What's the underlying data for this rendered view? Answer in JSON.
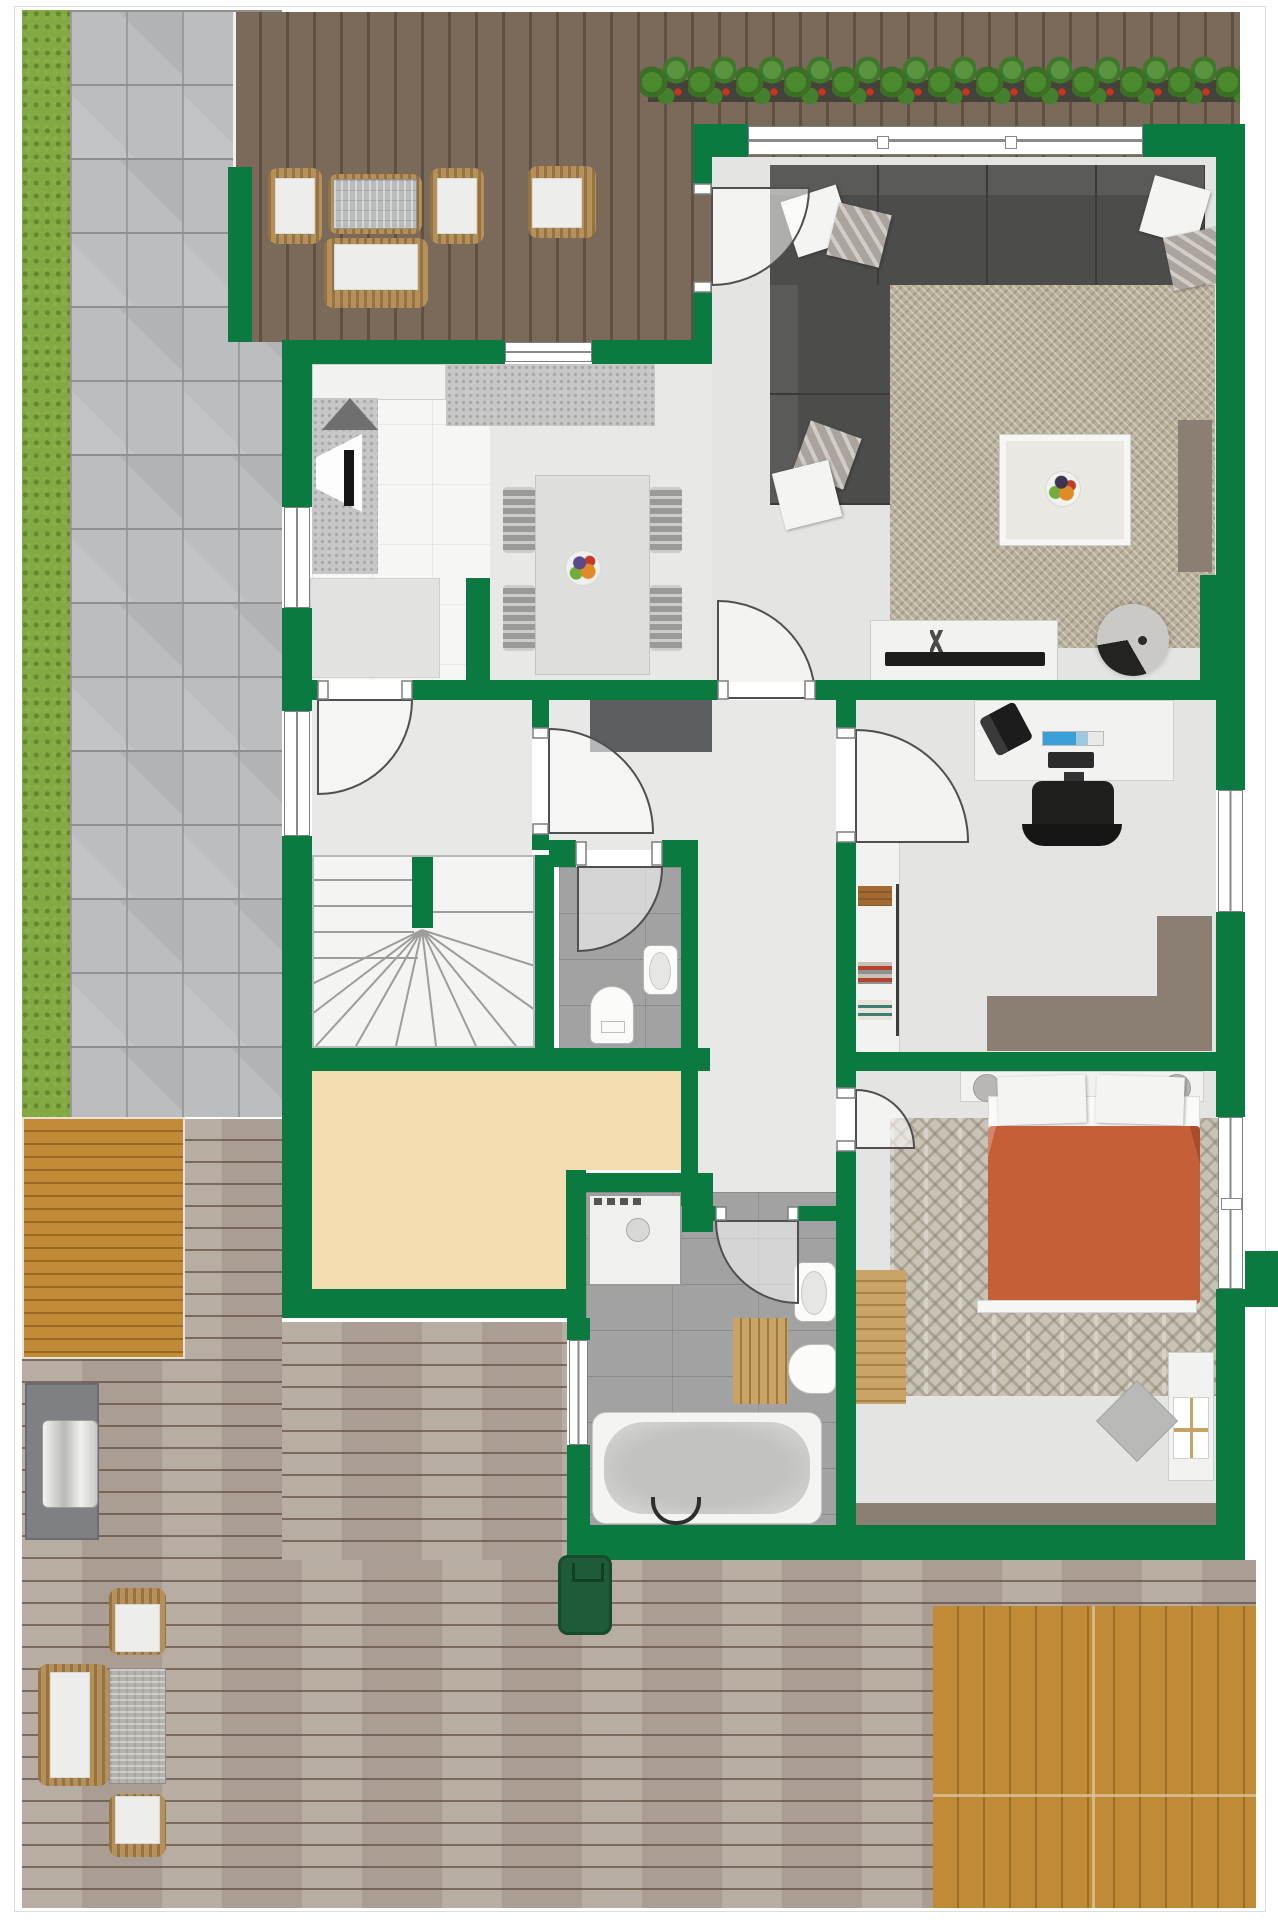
{
  "document": {
    "type": "architectural floor plan, top-down 3D render",
    "visible_text": [],
    "notes": "Ground floor plan with green walls, surrounded by lawn strip, paved path, two wooden terraces and a flower border. No text labels are rendered in the image."
  },
  "palette": {
    "wall": "#0a7a40",
    "grass": "#83a943",
    "paver": "#bcbdbf",
    "deck_top": "#7b6a59",
    "deck_bottom": "#b3a79c",
    "deck_gold": "#c08a37",
    "floor": "#e4e4e3",
    "kitchen_floor": "#f6f6f5",
    "tile_gray": "#a2a2a2",
    "beige": "#f5ddb2",
    "rug_living": "#b9b09c",
    "rug_bedroom": "#c9c3b5",
    "sofa": "#4c4c4a",
    "taupe": "#8b7e72",
    "duvet": "#c45f38",
    "wood_tan": "#c9a368",
    "wicker": "#b6905a",
    "bin_green": "#1e5b38",
    "soil": "#45423a",
    "leaf": "#4c8a2e",
    "bloom": "#d0331c",
    "door_line": "#4f4f4f"
  },
  "outdoor": {
    "areas": [
      "lawn-strip-west",
      "paved-path",
      "upper-terrace-dark-wood",
      "flower-border",
      "lower-terrace-grey-wood",
      "golden-deck-panel-west",
      "golden-deck-panel-southeast"
    ],
    "items": [
      "terrace-armchair",
      "terrace-armchair",
      "terrace-glass-table",
      "terrace-sofa",
      "terrace-side-chair",
      "garden-lounge-chair",
      "garden-lounge-chair",
      "garden-sofa",
      "garden-wicker-table",
      "outdoor-grill-station",
      "green-wheelie-bin"
    ]
  },
  "rooms": [
    {
      "name": "living-room",
      "furniture": [
        "corner-sofa",
        "throw-pillows",
        "area-rug",
        "coffee-table-tray",
        "fruit-bowl",
        "tv-sideboard",
        "television",
        "round-fan",
        "side-bench"
      ]
    },
    {
      "name": "kitchen",
      "furniture": [
        "upper-counter",
        "worktop",
        "extractor-hood",
        "corner-sink",
        "kitchen-island"
      ]
    },
    {
      "name": "dining-area",
      "furniture": [
        "dining-table",
        "dining-chairs-x4",
        "fruit-bowl",
        "dark-sideboard"
      ]
    },
    {
      "name": "entrance-vestibule",
      "furniture": []
    },
    {
      "name": "staircase",
      "furniture": [
        "winder-stairs"
      ]
    },
    {
      "name": "guest-wc",
      "furniture": [
        "wall-sink",
        "toilet"
      ]
    },
    {
      "name": "office",
      "furniture": [
        "desk",
        "desk-phone",
        "monitor",
        "keyboard",
        "office-chair",
        "bookshelf",
        "l-shaped-side-desk"
      ]
    },
    {
      "name": "storage-room-beige",
      "furniture": []
    },
    {
      "name": "corridor",
      "furniture": []
    },
    {
      "name": "bathroom",
      "furniture": [
        "shower",
        "bathtub",
        "wall-sink",
        "second-basin",
        "wooden-bath-mat"
      ]
    },
    {
      "name": "bedroom",
      "furniture": [
        "double-bed-orange-duvet",
        "headboard-nightstands",
        "bedside-lamps",
        "bedroom-rug",
        "wood-bench",
        "vanity-desk",
        "vanity-chair",
        "low-wardrobe"
      ]
    }
  ],
  "openings": {
    "windows": 7,
    "exterior_doors": 1,
    "interior_door_swings": 7
  }
}
